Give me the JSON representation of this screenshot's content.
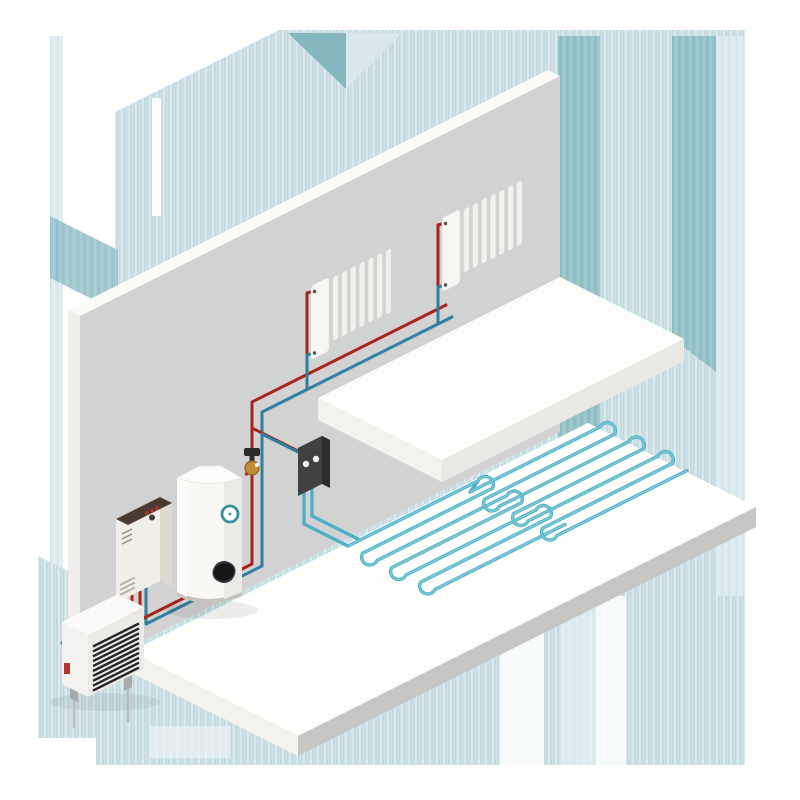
{
  "scene": {
    "title": "isometric-hydronic-heating-system-illustration",
    "canvas_px": 800,
    "rooms": "cutaway wall with mezzanine floor and ground slab"
  },
  "colors": {
    "supply_pipe": "#a6241c",
    "return_pipe": "#2e7fa0",
    "floor_loop": "#4fb0c5",
    "floor_loop_highlight": "#82ccdb",
    "wall": "#d2d2d3",
    "wall_top": "#fbfaf7",
    "wall_end": "#f0eeea",
    "floor_top": "#fefefd",
    "floor_edge_gray": "#c6c6c5",
    "floor_edge_light": "#f4f2ed",
    "mezzanine_top": "#fdfdfb",
    "background_wash": "#d3e4e8",
    "background_wash_dark": "#93c0c8",
    "background_wash_pale": "#dfecef",
    "equipment_white": "#f2efe9",
    "boiler_top_brown": "#4a3b32",
    "manifold_black": "#414144",
    "valve_brass": "#c08f35",
    "louver_black": "#26262a",
    "label_red": "#b5342a",
    "indicator_red": "#c03026"
  },
  "components": {
    "heat_pump": {
      "name": "outdoor heat pump unit",
      "louver_count": 10,
      "feet": 2,
      "label_color": "#b5342a"
    },
    "boiler": {
      "name": "wall hung boiler",
      "indicator_lights": 3,
      "vent_lines_top": 3,
      "vent_lines_bottom": 3,
      "top_color": "#4a3b32"
    },
    "tank": {
      "name": "hot water storage cylinder",
      "gauge": "round dial",
      "port": "black side connection"
    },
    "valve": {
      "name": "brass mixing valve",
      "dots": 2
    },
    "manifold": {
      "name": "underfloor heating control box",
      "dials": 2
    },
    "radiator_small": {
      "name": "wall radiator left",
      "fins": 7,
      "connections": 2
    },
    "radiator_large": {
      "name": "wall radiator right",
      "fins": 7,
      "connections": 2
    },
    "floor_loop_left": {
      "name": "underfloor heating circuit left",
      "passes": 7
    },
    "floor_loop_right": {
      "name": "underfloor heating circuit right",
      "passes": 7
    }
  }
}
